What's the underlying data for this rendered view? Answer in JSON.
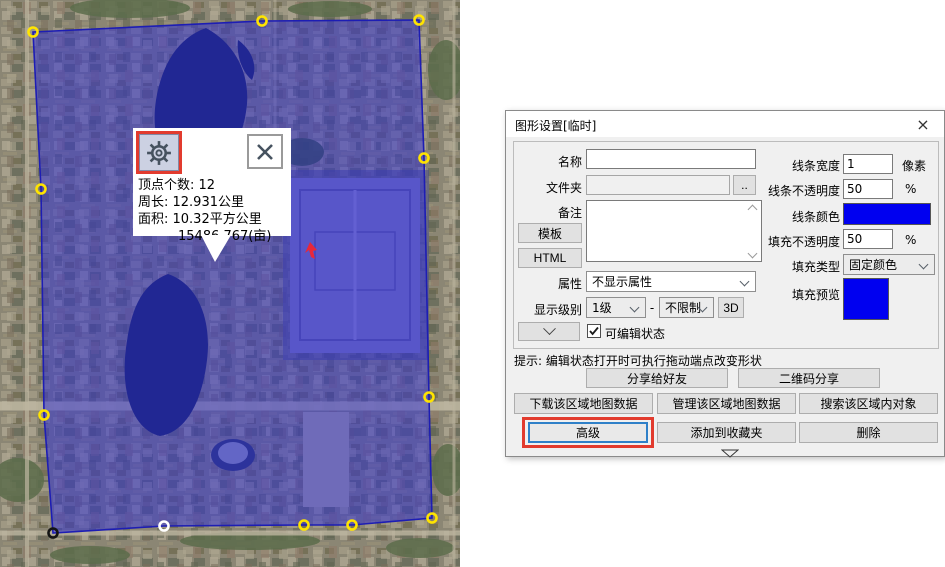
{
  "highlight_color": "#e23b2e",
  "map": {
    "tooltip": {
      "stats": {
        "vertices": "顶点个数: 12",
        "perimeter": "周长: 12.931公里",
        "area": "面积: 10.32平方公里",
        "area_mu": "15486.767(亩)"
      },
      "icons": {
        "settings": "gear-icon",
        "close": "close-icon"
      }
    },
    "marker_color": "#e8273a",
    "polygon": {
      "vertex_count": 12,
      "fill": "#2b2bd8",
      "fill_opacity": 0.5,
      "stroke": "#1d1db4",
      "vertices": [
        {
          "x": 33,
          "y": 32,
          "color": "#ffe400"
        },
        {
          "x": 262,
          "y": 21,
          "color": "#ffe400"
        },
        {
          "x": 419,
          "y": 20,
          "color": "#ffe400"
        },
        {
          "x": 424,
          "y": 158,
          "color": "#ffe400"
        },
        {
          "x": 429,
          "y": 397,
          "color": "#ffe400"
        },
        {
          "x": 432,
          "y": 518,
          "color": "#ffe400"
        },
        {
          "x": 352,
          "y": 525,
          "color": "#ffe400"
        },
        {
          "x": 304,
          "y": 525,
          "color": "#ffe400"
        },
        {
          "x": 164,
          "y": 526,
          "color": "#ffffff"
        },
        {
          "x": 53,
          "y": 533,
          "color": "#141414"
        },
        {
          "x": 44,
          "y": 415,
          "color": "#ffe400"
        },
        {
          "x": 41,
          "y": 189,
          "color": "#ffe400"
        }
      ]
    }
  },
  "dialog": {
    "title": "图形设置[临时]",
    "close_glyph": "×",
    "fields": {
      "name_label": "名称",
      "name_value": "",
      "folder_label": "文件夹",
      "folder_value": "",
      "folder_browse": "..",
      "note_label": "备注",
      "note_value": "",
      "template_button": "模板",
      "html_button": "HTML",
      "attr_label": "属性",
      "attr_value": "不显示属性",
      "level_label": "显示级别",
      "level_min": "1级",
      "level_sep": "-",
      "level_max": "不限制",
      "btn_3d": "3D",
      "editable_checkbox": "可编辑状态",
      "editable_checked": true,
      "line_width_label": "线条宽度",
      "line_width_value": "1",
      "line_width_unit": "像素",
      "line_opacity_label": "线条不透明度",
      "line_opacity_value": "50",
      "line_opacity_unit": "%",
      "line_color_label": "线条颜色",
      "line_color": "#0000f0",
      "fill_opacity_label": "填充不透明度",
      "fill_opacity_value": "50",
      "fill_opacity_unit": "%",
      "fill_type_label": "填充类型",
      "fill_type_value": "固定颜色",
      "fill_preview_label": "填充预览",
      "fill_color": "#0000f0"
    },
    "tip": "提示: 编辑状态打开时可执行拖动端点改变形状",
    "buttons": {
      "share_friend": "分享给好友",
      "share_qrcode": "二维码分享",
      "download_area": "下载该区域地图数据",
      "manage_area": "管理该区域地图数据",
      "search_area": "搜索该区域内对象",
      "advanced": "高级",
      "add_favorite": "添加到收藏夹",
      "delete": "删除"
    }
  }
}
